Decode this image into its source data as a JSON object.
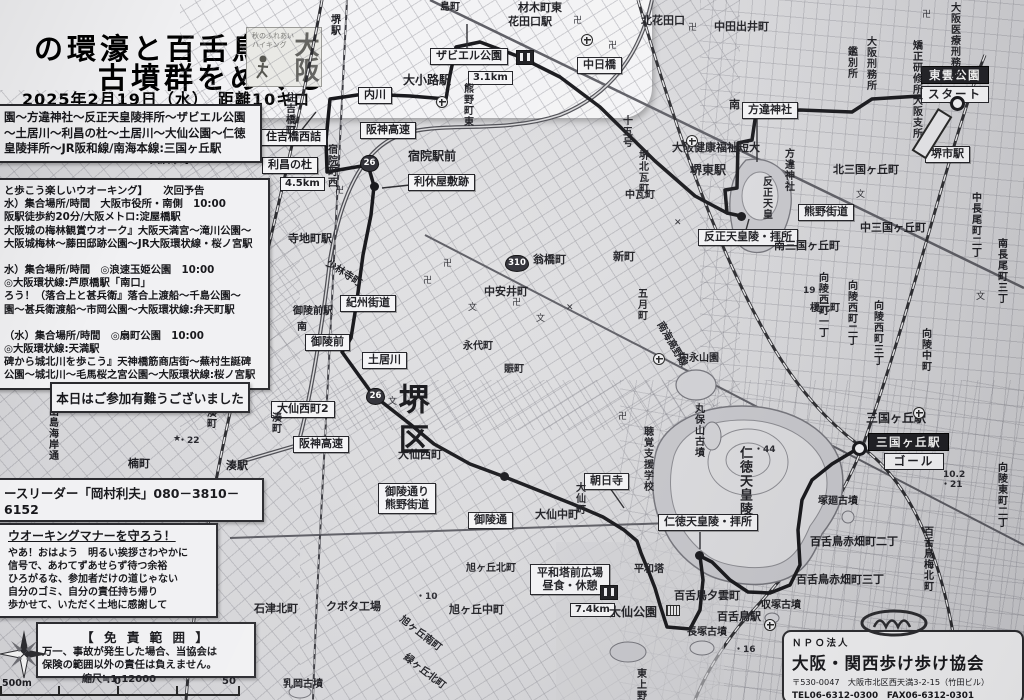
{
  "header": {
    "title_line1": "の環濠と百舌鳥",
    "title_line2": "古墳群をめぐる",
    "date_line": "2025年2月19日（水）　距離10キロ",
    "logo": {
      "small_line1": "秋のふれあい",
      "small_line2": "ハイキング",
      "big": "大阪"
    }
  },
  "course_box": {
    "lines": [
      "園～方違神社～反正天皇陵拝所～ザビエル公園",
      "～土居川～利昌の杜～土居川～大仙公園～仁徳",
      "皇陵拝所～JR阪和線/南海本線:三国ヶ丘駅"
    ]
  },
  "next_walk_box": {
    "lines": [
      "と歩こう楽しいウオーキング】　　次回予告",
      "水）集合場所/時間　大阪市役所・南側　10:00",
      "阪駅徒歩約20分/大阪メトロ:淀屋橋駅",
      "大阪城の梅林観賞ウオーク』大阪天満宮～滝川公園～",
      "大阪城梅林～藤田邸跡公園～JR大阪環状線・桜ノ宮駅",
      "",
      "水）集合場所/時間　◎浪速玉姫公園　10:00",
      "◎大阪環状線:芦原橋駅「南口」",
      "ろう！（落合上と甚兵衛』落合上渡船～千島公園～",
      "園～甚兵衛渡船～市岡公園～大阪環状線:弁天町駅",
      "",
      "（水）集合場所/時間　◎扇町公園　10:00",
      "◎大阪環状線:天満駅",
      "碑から城北川を歩こう』天神橋筋商店街～蕪村生誕碑",
      "公園～城北川～毛馬桜之宮公園～大阪環状線:桜ノ宮駅"
    ]
  },
  "thanks_box": {
    "text": "本日はご参加有難うございました"
  },
  "leader_strip": {
    "text": "ースリーダー「岡村利夫」080－3810－6152"
  },
  "manner_box": {
    "title": "ウオーキングマナーを守ろう！",
    "lines": [
      "やあ！おはよう　明るい挨拶さわやかに",
      "信号で、あわてずあせらず待つ余裕",
      "ひろがるな、参加者だけの道じゃない",
      "自分のゴミ、自分の責任持ち帰り",
      "歩かせて、いただく土地に感謝して"
    ]
  },
  "disclaimer_box": {
    "title": "【 免 責 範 囲 】",
    "lines": [
      "万一、事故が発生した場合、当協会は",
      "保険の範囲以外の責任は負えません。"
    ]
  },
  "scale": {
    "title": "縮尺≒1:12000",
    "left_label": "500m",
    "zero_label": "0",
    "right_label": "50"
  },
  "npo_box": {
    "org_type": "ＮＰＯ法人",
    "name": "大阪・関西歩け歩け協会",
    "address": "〒530-0047　大阪市北区西天満3-2-15（竹田ビル）",
    "tel_fax": "TEL06-6312-0300　FAX06-6312-0301",
    "url": "URL:http://www.kansaiaruke.com/"
  },
  "colors": {
    "paper": "#d7d7d9",
    "route": "#141418",
    "label_bg": "#f4f4f6",
    "label_border": "#1f1f24"
  },
  "map": {
    "start_label": "スタート",
    "goal_label": "ゴール",
    "labels": [
      {
        "t": "ザビエル公園",
        "s": "box",
        "x": 430,
        "y": 48
      },
      {
        "t": "",
        "s": "wc",
        "x": 516,
        "y": 50
      },
      {
        "t": "3.1km",
        "s": "boxsm",
        "x": 468,
        "y": 71
      },
      {
        "t": "中日橋",
        "s": "box",
        "x": 577,
        "y": 57
      },
      {
        "t": "東雲公園",
        "s": "black",
        "x": 921,
        "y": 66
      },
      {
        "t": "スタート",
        "s": "white",
        "x": 921,
        "y": 86
      },
      {
        "t": "堺市駅",
        "s": "box",
        "x": 925,
        "y": 146
      },
      {
        "t": "方違神社",
        "s": "box",
        "x": 742,
        "y": 102
      },
      {
        "t": "反正天皇陵・拝所",
        "s": "box",
        "x": 698,
        "y": 229
      },
      {
        "t": "熊野街道",
        "s": "box",
        "x": 798,
        "y": 204
      },
      {
        "t": "住吉橋西詰",
        "s": "box",
        "x": 260,
        "y": 129
      },
      {
        "t": "利昌の杜",
        "s": "box",
        "x": 262,
        "y": 157
      },
      {
        "t": "4.5km",
        "s": "boxsm",
        "x": 280,
        "y": 177
      },
      {
        "t": "利休屋敷跡",
        "s": "box",
        "x": 408,
        "y": 174
      },
      {
        "t": "内川",
        "s": "box",
        "x": 358,
        "y": 87
      },
      {
        "t": "紀州街道",
        "s": "box",
        "x": 340,
        "y": 295
      },
      {
        "t": "御陵前",
        "s": "box",
        "x": 305,
        "y": 334
      },
      {
        "t": "土居川",
        "s": "box",
        "x": 362,
        "y": 352
      },
      {
        "t": "大仙西町2",
        "s": "box",
        "x": 271,
        "y": 401
      },
      {
        "t": "阪神高速",
        "s": "box",
        "x": 360,
        "y": 122
      },
      {
        "t": "阪神高速",
        "s": "box",
        "x": 293,
        "y": 436
      },
      {
        "t": "御陵通り\n熊野街道",
        "s": "box2",
        "x": 378,
        "y": 483
      },
      {
        "t": "御陵通",
        "s": "box",
        "x": 468,
        "y": 512
      },
      {
        "t": "朝日寺",
        "s": "box",
        "x": 584,
        "y": 473
      },
      {
        "t": "平和塔前広場\n昼食・休憩",
        "s": "box2",
        "x": 530,
        "y": 564
      },
      {
        "t": "",
        "s": "wc",
        "x": 600,
        "y": 585
      },
      {
        "t": "7.4km",
        "s": "boxsm",
        "x": 570,
        "y": 603
      },
      {
        "t": "仁徳天皇陵・拝所",
        "s": "box",
        "x": 658,
        "y": 514
      },
      {
        "t": "三国ヶ丘駅",
        "s": "black",
        "x": 868,
        "y": 433
      },
      {
        "t": "ゴール",
        "s": "white",
        "x": 884,
        "y": 453,
        "w": 46
      },
      {
        "t": "宿院駅前",
        "s": "p",
        "x": 408,
        "y": 150,
        "fs": 12
      },
      {
        "t": "堺駅",
        "s": "v",
        "x": 328,
        "y": 14
      },
      {
        "t": "島町",
        "s": "p",
        "x": 440,
        "y": 2
      },
      {
        "t": "材木町東",
        "s": "p",
        "x": 518,
        "y": 2,
        "fs": 11
      },
      {
        "t": "花田口駅",
        "s": "p",
        "x": 508,
        "y": 16,
        "fs": 11
      },
      {
        "t": "北花田口",
        "s": "p",
        "x": 641,
        "y": 15,
        "fs": 11
      },
      {
        "t": "中田出井町",
        "s": "p",
        "x": 714,
        "y": 21,
        "fs": 11
      },
      {
        "t": "大阪医療刑務所",
        "s": "v",
        "x": 948,
        "y": 2
      },
      {
        "t": "大阪刑務所",
        "s": "v",
        "x": 864,
        "y": 36
      },
      {
        "t": "鑑別所",
        "s": "v",
        "x": 845,
        "y": 46
      },
      {
        "t": "矯正研修所大阪支所",
        "s": "v",
        "x": 910,
        "y": 40
      },
      {
        "t": "北三国ヶ丘町",
        "s": "p",
        "x": 833,
        "y": 164,
        "fs": 11
      },
      {
        "t": "中三国ヶ丘町",
        "s": "p",
        "x": 860,
        "y": 222,
        "fs": 11
      },
      {
        "t": "南三国ヶ丘町",
        "s": "p",
        "x": 774,
        "y": 240,
        "fs": 11
      },
      {
        "t": "中長尾町二丁",
        "s": "v",
        "x": 969,
        "y": 192
      },
      {
        "t": "南長尾町三丁",
        "s": "v",
        "x": 995,
        "y": 238
      },
      {
        "t": "向陵西町一丁",
        "s": "v",
        "x": 816,
        "y": 272
      },
      {
        "t": "向陵西町二丁",
        "s": "v",
        "x": 845,
        "y": 280
      },
      {
        "t": "向陵西町三丁",
        "s": "v",
        "x": 871,
        "y": 300
      },
      {
        "t": "向陵中町",
        "s": "v",
        "x": 919,
        "y": 328
      },
      {
        "t": "向陵東町二丁",
        "s": "v",
        "x": 995,
        "y": 462
      },
      {
        "t": "堺東駅",
        "s": "p",
        "x": 690,
        "y": 164,
        "fs": 12
      },
      {
        "t": "大阪健康福祉短大",
        "s": "p",
        "x": 672,
        "y": 142,
        "fs": 11
      },
      {
        "t": "方違神社",
        "s": "v",
        "x": 782,
        "y": 148
      },
      {
        "t": "反正天皇",
        "s": "v",
        "x": 760,
        "y": 176
      },
      {
        "t": "南",
        "s": "p",
        "x": 729,
        "y": 99,
        "fs": 11
      },
      {
        "t": "十五号",
        "s": "v",
        "x": 620,
        "y": 115
      },
      {
        "t": "堺北瓦町",
        "s": "v",
        "x": 636,
        "y": 150
      },
      {
        "t": "中瓦町",
        "s": "p",
        "x": 625,
        "y": 190
      },
      {
        "t": "熊野町東",
        "s": "v",
        "x": 461,
        "y": 83
      },
      {
        "t": "大小路駅",
        "s": "p",
        "x": 403,
        "y": 74,
        "fs": 12
      },
      {
        "t": "宿院町西",
        "s": "v",
        "x": 325,
        "y": 144
      },
      {
        "t": "住吉橋町",
        "s": "v",
        "x": 283,
        "y": 92
      },
      {
        "t": "寺地町駅",
        "s": "p",
        "x": 288,
        "y": 233,
        "fs": 11
      },
      {
        "t": "少林寺町",
        "s": "p",
        "x": 330,
        "y": 258,
        "r": 33
      },
      {
        "t": "御陵前駅",
        "s": "p",
        "x": 293,
        "y": 306
      },
      {
        "t": "南",
        "s": "p",
        "x": 297,
        "y": 322
      },
      {
        "t": "永代町",
        "s": "p",
        "x": 463,
        "y": 341
      },
      {
        "t": "賑町",
        "s": "p",
        "x": 504,
        "y": 364
      },
      {
        "t": "翁橋町",
        "s": "p",
        "x": 533,
        "y": 254,
        "fs": 11
      },
      {
        "t": "新町",
        "s": "p",
        "x": 613,
        "y": 251,
        "fs": 11
      },
      {
        "t": "中安井町",
        "s": "p",
        "x": 484,
        "y": 286,
        "fs": 11
      },
      {
        "t": "五月町",
        "s": "v",
        "x": 635,
        "y": 288
      },
      {
        "t": "中永山園",
        "s": "p",
        "x": 679,
        "y": 353
      },
      {
        "t": "榎元町",
        "s": "p",
        "x": 810,
        "y": 303
      },
      {
        "t": "南海高野線",
        "s": "p",
        "x": 664,
        "y": 320,
        "r": 60
      },
      {
        "t": "湊町",
        "s": "v",
        "x": 269,
        "y": 412
      },
      {
        "t": "湊駅",
        "s": "p",
        "x": 226,
        "y": 460,
        "fs": 11
      },
      {
        "t": "楠町",
        "s": "p",
        "x": 128,
        "y": 458,
        "fs": 11
      },
      {
        "t": "出島海岸通",
        "s": "v",
        "x": 46,
        "y": 406
      },
      {
        "t": "西湊町",
        "s": "v",
        "x": 204,
        "y": 396
      },
      {
        "t": "柏木町",
        "s": "p",
        "x": 90,
        "y": 501
      },
      {
        "t": "老松町",
        "s": "p",
        "x": 90,
        "y": 549
      },
      {
        "t": "旭ヶ丘北町",
        "s": "p",
        "x": 466,
        "y": 563
      },
      {
        "t": "石津北町",
        "s": "p",
        "x": 254,
        "y": 603,
        "fs": 11
      },
      {
        "t": "クボタ工場",
        "s": "p",
        "x": 326,
        "y": 601,
        "fs": 11
      },
      {
        "t": "旭ヶ丘中町",
        "s": "p",
        "x": 449,
        "y": 604,
        "fs": 11
      },
      {
        "t": "旭ヶ丘南町",
        "s": "p",
        "x": 404,
        "y": 614,
        "r": 38
      },
      {
        "t": "緑ヶ丘北町",
        "s": "p",
        "x": 408,
        "y": 652,
        "r": 38
      },
      {
        "t": "乳岡古墳",
        "s": "p",
        "x": 283,
        "y": 679
      },
      {
        "t": "東上野芝町",
        "s": "v",
        "x": 634,
        "y": 668
      },
      {
        "t": "大仙中町",
        "s": "p",
        "x": 535,
        "y": 509,
        "fs": 11
      },
      {
        "t": "大仙町",
        "s": "v",
        "x": 573,
        "y": 482
      },
      {
        "t": "大仙西町",
        "s": "p",
        "x": 398,
        "y": 449,
        "fs": 11
      },
      {
        "t": "平和塔",
        "s": "p",
        "x": 634,
        "y": 564
      },
      {
        "t": "大仙公園",
        "s": "p",
        "x": 609,
        "y": 606,
        "fs": 12
      },
      {
        "t": "",
        "s": "bld",
        "x": 666,
        "y": 605
      },
      {
        "t": "百舌鳥夕雲町",
        "s": "p",
        "x": 674,
        "y": 590,
        "fs": 11
      },
      {
        "t": "収塚古墳",
        "s": "p",
        "x": 761,
        "y": 600
      },
      {
        "t": "百舌鳥駅",
        "s": "p",
        "x": 717,
        "y": 611,
        "fs": 11
      },
      {
        "t": "長塚古墳",
        "s": "p",
        "x": 687,
        "y": 627
      },
      {
        "t": "百舌鳥赤畑町二丁",
        "s": "p",
        "x": 810,
        "y": 536,
        "fs": 11
      },
      {
        "t": "百舌鳥赤畑町三丁",
        "s": "p",
        "x": 796,
        "y": 574,
        "fs": 11
      },
      {
        "t": "百舌鳥梅北町",
        "s": "v",
        "x": 921,
        "y": 526
      },
      {
        "t": "塚廻古墳",
        "s": "p",
        "x": 818,
        "y": 496
      },
      {
        "t": "丸保山古墳",
        "s": "v",
        "x": 692,
        "y": 403
      },
      {
        "t": "仁徳天皇陵",
        "s": "v",
        "x": 736,
        "y": 446,
        "fs": 13
      },
      {
        "t": "聴覚支援学校",
        "s": "v",
        "x": 641,
        "y": 426
      },
      {
        "t": "三国ヶ丘駅",
        "s": "p",
        "x": 866,
        "y": 412,
        "fs": 12
      },
      {
        "t": "堺区",
        "s": "big",
        "x": 392,
        "y": 383
      },
      {
        "t": "大浜中町",
        "s": "p",
        "x": 150,
        "y": 155
      },
      {
        "t": "26",
        "s": "shield",
        "x": 360,
        "y": 155
      },
      {
        "t": "26",
        "s": "shield",
        "x": 366,
        "y": 388
      },
      {
        "t": "310",
        "s": "shield",
        "x": 505,
        "y": 255,
        "w": 22
      },
      {
        "t": "・44",
        "s": "num",
        "x": 754,
        "y": 445
      },
      {
        "t": "10.2",
        "s": "num",
        "x": 943,
        "y": 470
      },
      {
        "t": "・21",
        "s": "num",
        "x": 941,
        "y": 480
      },
      {
        "t": "・10",
        "s": "num",
        "x": 416,
        "y": 592
      },
      {
        "t": "19・",
        "s": "num",
        "x": 803,
        "y": 286
      },
      {
        "t": "・16",
        "s": "num",
        "x": 734,
        "y": 645
      },
      {
        "t": "・22",
        "s": "num",
        "x": 178,
        "y": 436
      },
      {
        "t": "卍",
        "s": "sym",
        "x": 443,
        "y": 259
      },
      {
        "t": "卍",
        "s": "sym",
        "x": 423,
        "y": 276
      },
      {
        "t": "卍",
        "s": "sym",
        "x": 335,
        "y": 186
      },
      {
        "t": "卍",
        "s": "sym",
        "x": 573,
        "y": 16
      },
      {
        "t": "卍",
        "s": "sym",
        "x": 608,
        "y": 41
      },
      {
        "t": "卍",
        "s": "sym",
        "x": 688,
        "y": 23
      },
      {
        "t": "卍",
        "s": "sym",
        "x": 922,
        "y": 10
      },
      {
        "t": "卍",
        "s": "sym",
        "x": 618,
        "y": 412
      },
      {
        "t": "卍",
        "s": "sym",
        "x": 512,
        "y": 298
      },
      {
        "t": "文",
        "s": "sym",
        "x": 856,
        "y": 190
      },
      {
        "t": "文",
        "s": "sym",
        "x": 976,
        "y": 292
      },
      {
        "t": "文",
        "s": "sym",
        "x": 536,
        "y": 314
      },
      {
        "t": "文",
        "s": "sym",
        "x": 468,
        "y": 303
      },
      {
        "t": "文",
        "s": "sym",
        "x": 388,
        "y": 397
      },
      {
        "t": "✕",
        "s": "sym",
        "x": 566,
        "y": 303
      },
      {
        "t": "✕",
        "s": "sym",
        "x": 674,
        "y": 218
      },
      {
        "t": "★",
        "s": "sym",
        "x": 173,
        "y": 434
      },
      {
        "t": "",
        "s": "sta",
        "x": 581,
        "y": 34
      },
      {
        "t": "",
        "s": "sta",
        "x": 436,
        "y": 96
      },
      {
        "t": "",
        "s": "sta",
        "x": 686,
        "y": 135
      },
      {
        "t": "",
        "s": "sta",
        "x": 913,
        "y": 407
      },
      {
        "t": "",
        "s": "sta",
        "x": 192,
        "y": 401
      },
      {
        "t": "",
        "s": "sta",
        "x": 653,
        "y": 353
      },
      {
        "t": "",
        "s": "sta",
        "x": 764,
        "y": 619
      },
      {
        "t": "",
        "s": "rectb",
        "x": 938,
        "y": 108,
        "r": 32
      },
      {
        "t": "",
        "s": "dot2",
        "x": 950,
        "y": 96
      },
      {
        "t": "",
        "s": "dot2",
        "x": 852,
        "y": 441
      },
      {
        "t": "",
        "s": "dot",
        "x": 737,
        "y": 212
      },
      {
        "t": "",
        "s": "dot",
        "x": 370,
        "y": 182
      },
      {
        "t": "",
        "s": "dot",
        "x": 500,
        "y": 472
      },
      {
        "t": "",
        "s": "dot",
        "x": 695,
        "y": 551
      }
    ]
  }
}
